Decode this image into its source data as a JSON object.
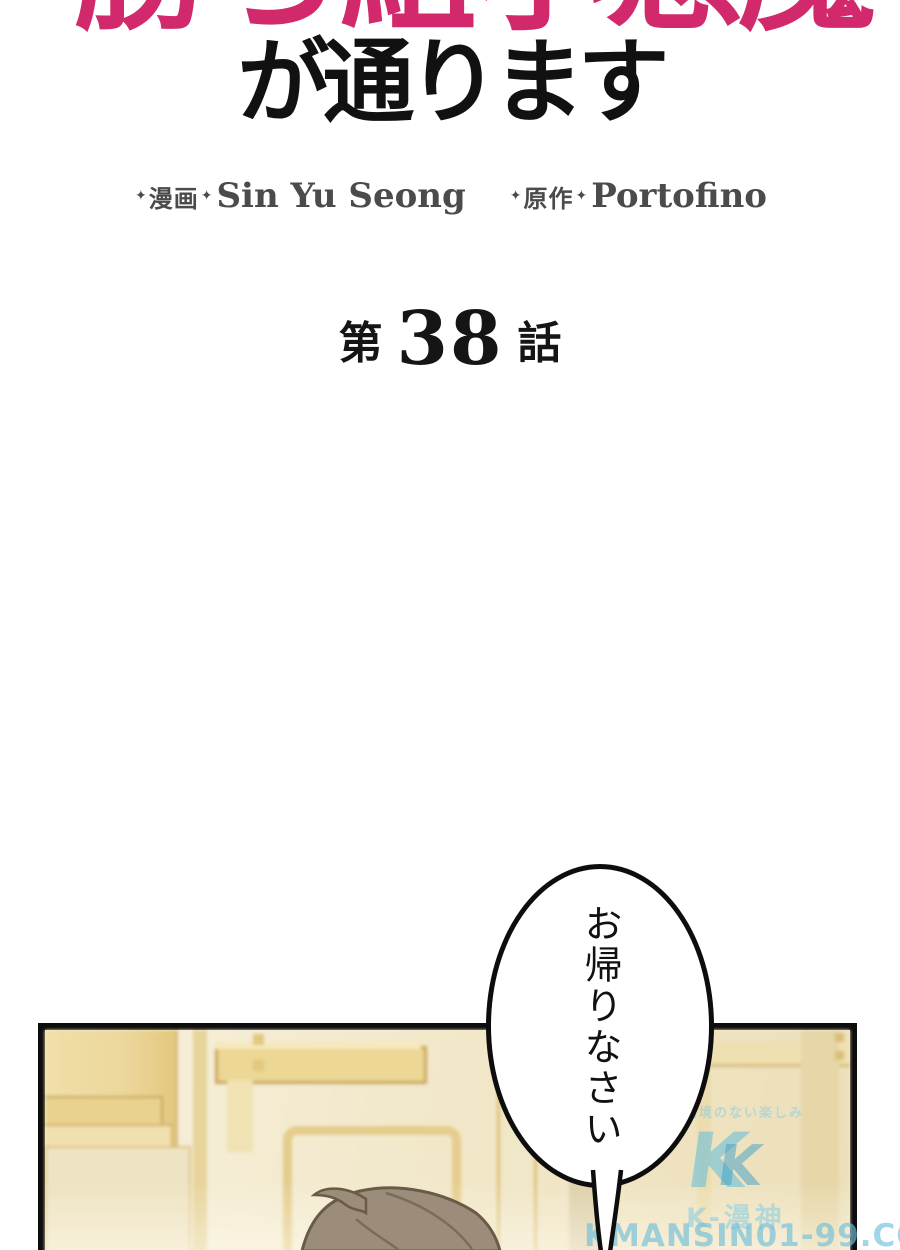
{
  "page": {
    "width": 900,
    "height": 1250,
    "background": "#ffffff"
  },
  "header": {
    "title_line1_cropped": "勝ち組小悪魔",
    "title_line2": "が通ります",
    "title_color": "#d2296d",
    "credits": {
      "diamond": "✦",
      "art_role_label": "漫画",
      "art_author": "Sin Yu Seong",
      "original_role_label": "原作",
      "original_author": "Portofino"
    }
  },
  "episode": {
    "prefix": "第",
    "number": "38",
    "suffix": "話"
  },
  "speech_bubble": {
    "text": "お帰りなさい"
  },
  "watermark": {
    "tagline": "国境のない楽しみ",
    "logo_letter": "K",
    "site_name": "K-漫神",
    "site_url": "KMANSIN01-99.COM",
    "accent_cyan": "#7ec8e0"
  },
  "panel": {
    "colors": {
      "cream": "#f4ecd3",
      "gold": "#e8d494",
      "gold_line": "#c9a75f",
      "hair": "#9c8c7a",
      "hair_outline": "#6a5a48",
      "border": "#0d0d0d"
    }
  }
}
